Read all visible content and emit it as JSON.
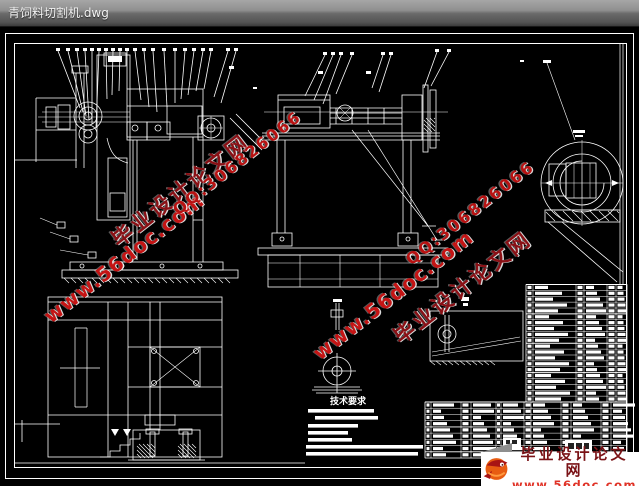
{
  "window": {
    "title": "青饲料切割机.dwg"
  },
  "canvas": {
    "background": "#000000",
    "line_color": "#ffffff"
  },
  "watermark": {
    "site_name": "毕业设计论文网",
    "site_url": "www.56doc.com",
    "qq": "QQ:306826066",
    "site_name_color": "#8a1015",
    "url_color": "#c41414",
    "qq_color": "#b81212"
  },
  "notes": {
    "title": "技术要求"
  },
  "logo": {
    "site_name": "毕业设计论文网",
    "site_url": "www.56doc.com",
    "name_color": "#7a1216",
    "url_color": "#e03226"
  },
  "bom": {
    "right_table_rows": 20,
    "bottom_table_rows": 9
  }
}
